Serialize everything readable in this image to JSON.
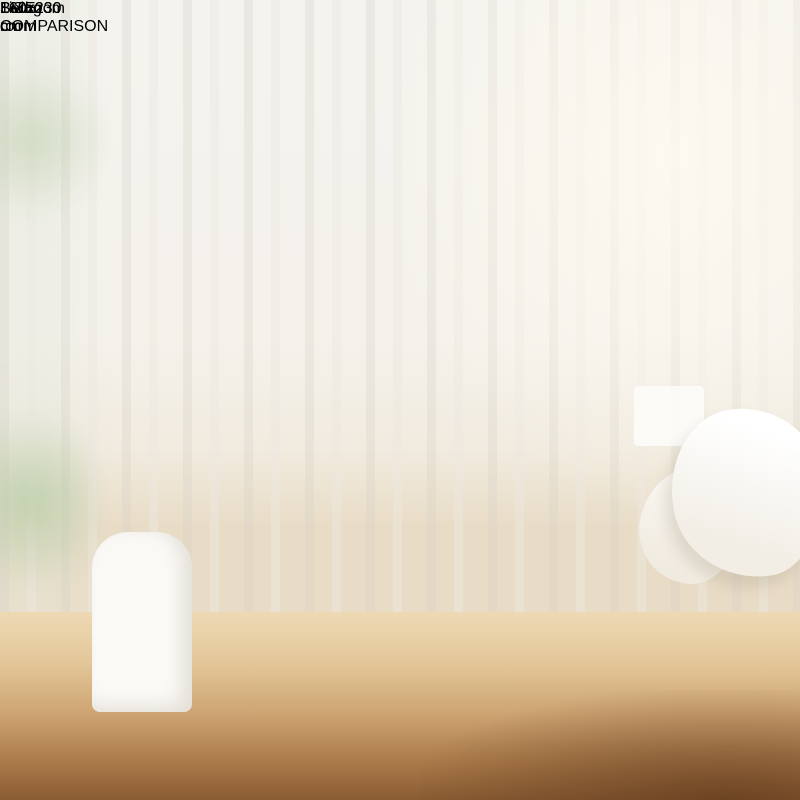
{
  "banner": {
    "title": "SIZE COMPARISON"
  },
  "panels": [
    {
      "id": "bedroom",
      "index": "1",
      "label": "Bedroom",
      "rug_size": "160x230 cm"
    },
    {
      "id": "living-room",
      "index": "1",
      "label": "Living room",
      "rug_size": "160x230 cm"
    }
  ],
  "colors": {
    "banner_yellow": "#F6C83E",
    "panel_gray": "#ACA9A1",
    "rug_blue": "#7287A7",
    "badge_gold": "#C0A125",
    "label_gray": "#6F6F6F",
    "furniture_stroke": "#BDBAB2"
  }
}
